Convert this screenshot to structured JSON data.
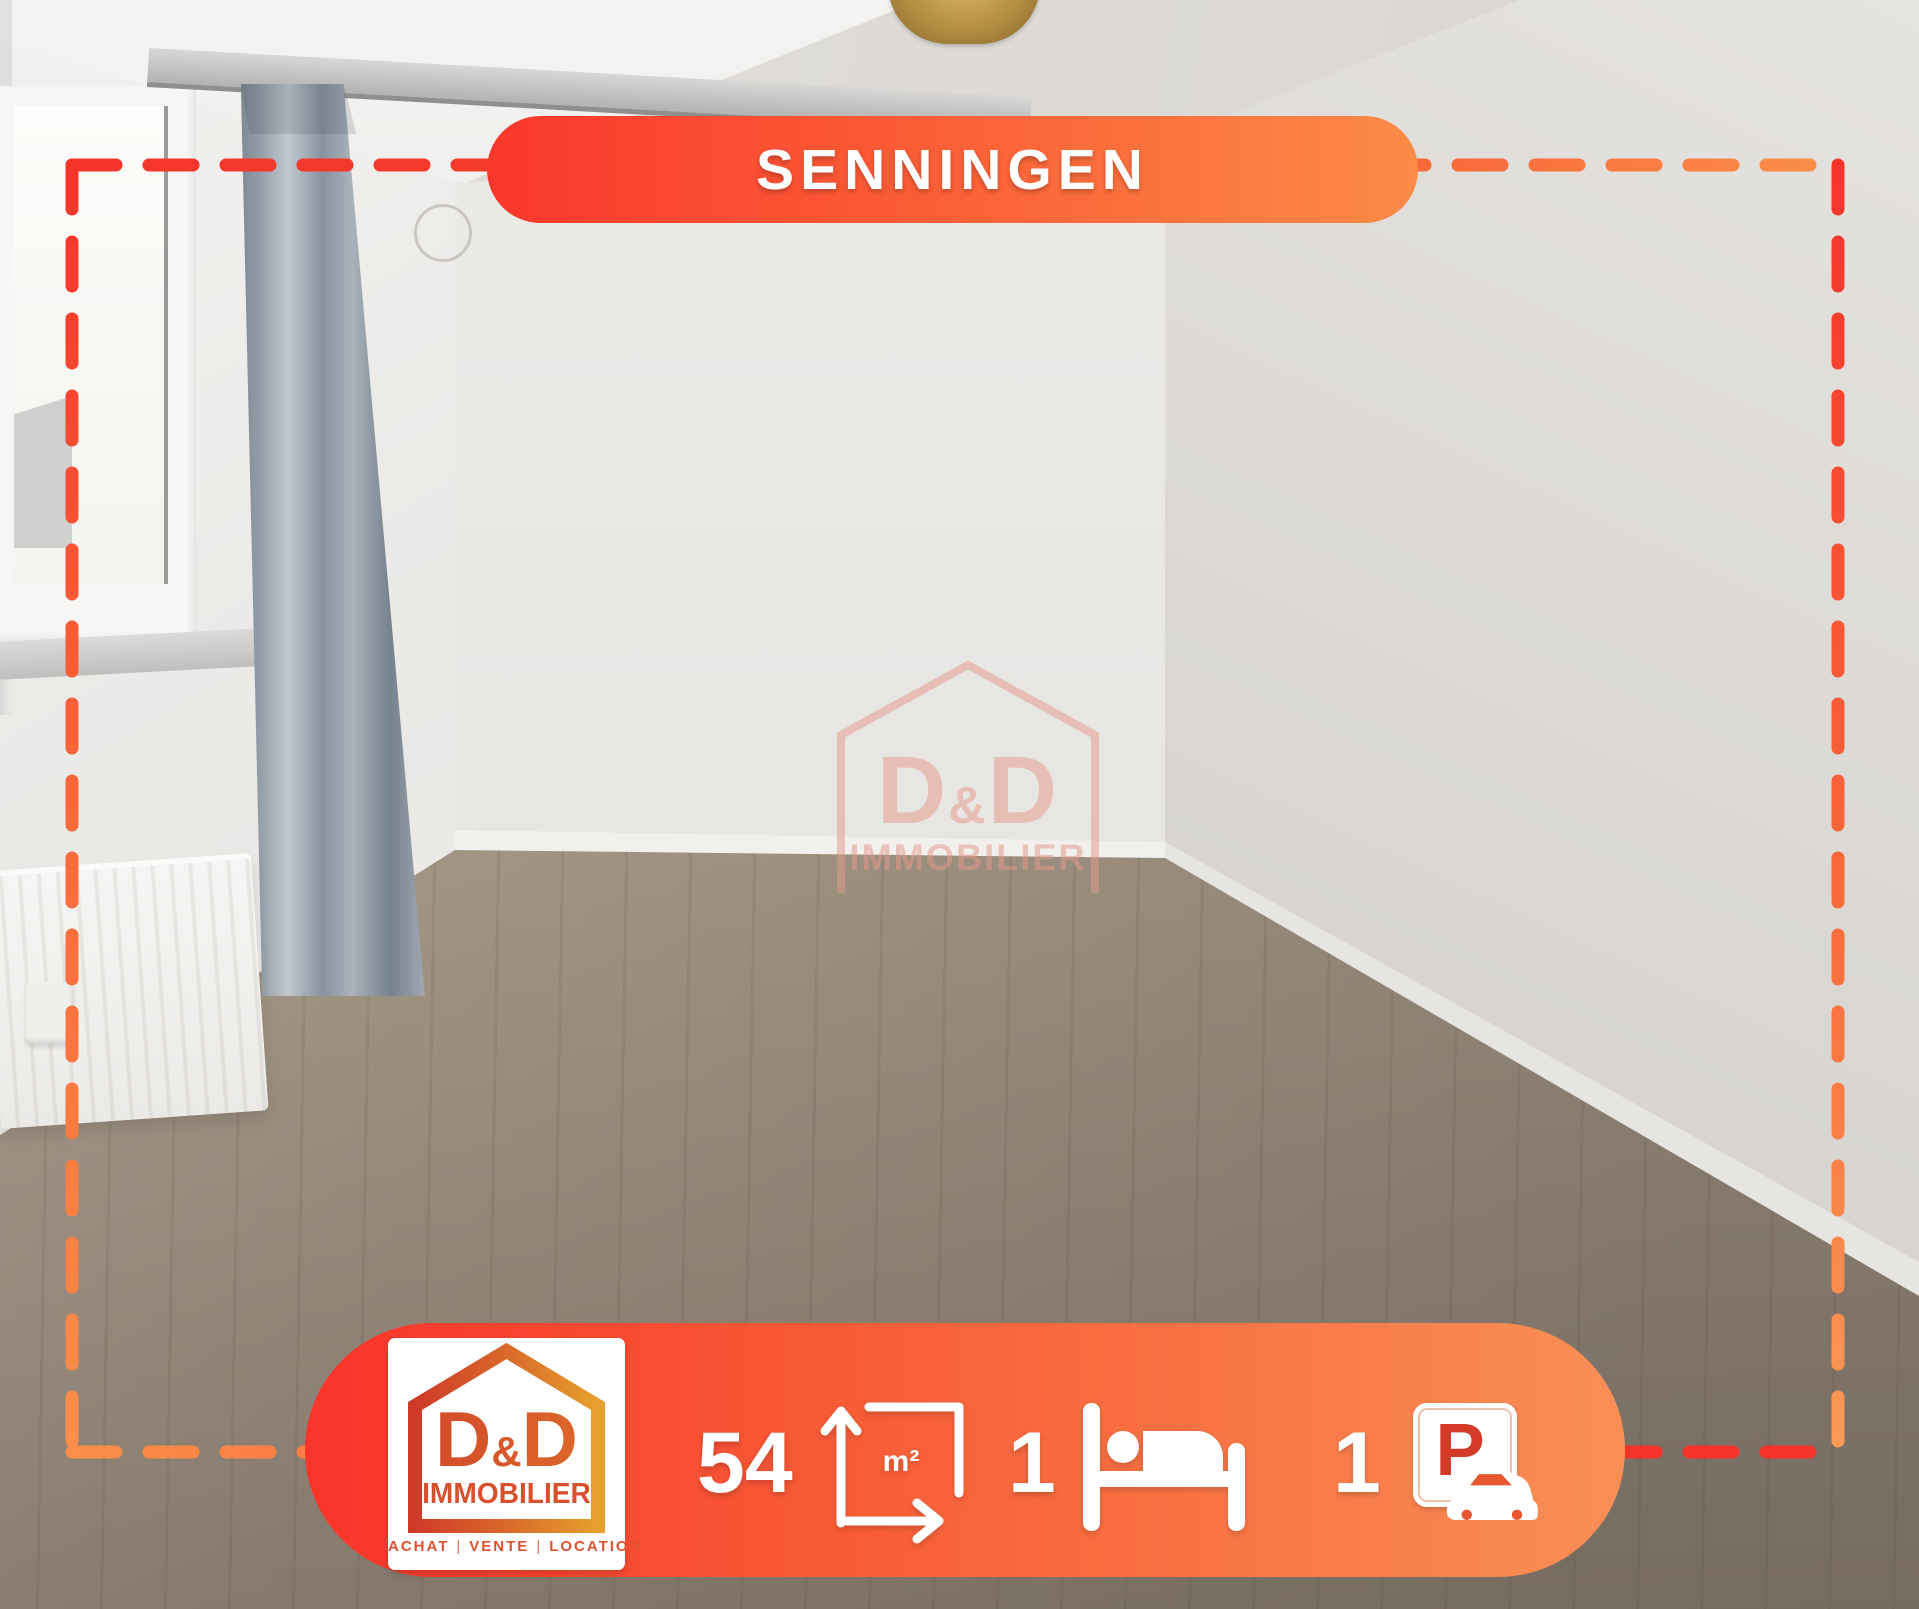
{
  "location_banner": {
    "text": "SENNINGEN"
  },
  "watermark": {
    "d_left": "D",
    "amp": "&",
    "d_right": "D",
    "subtitle": "IMMOBILIER"
  },
  "logo": {
    "d_left": "D",
    "amp": "&",
    "d_right": "D",
    "subtitle": "IMMOBILIER",
    "tagline": {
      "items": [
        "ACHAT",
        "VENTE",
        "LOCATION"
      ],
      "separator": "|"
    }
  },
  "stats": {
    "area": {
      "value": "54",
      "unit": "m²"
    },
    "bedrooms": {
      "value": "1"
    },
    "parking": {
      "value": "1",
      "sign_letter": "P"
    }
  },
  "colors": {
    "banner_gradient_start": "#F9382C",
    "banner_gradient_end": "#FA8F52",
    "dash_red": "#F4342B",
    "dash_orange": "#FB8E49",
    "logo_red": "#CF4429",
    "logo_gold": "#E5A02E",
    "sign_letter_red": "#D33A28",
    "text_white": "#FFFFFF",
    "watermark_salmon": "#E59A8C"
  }
}
